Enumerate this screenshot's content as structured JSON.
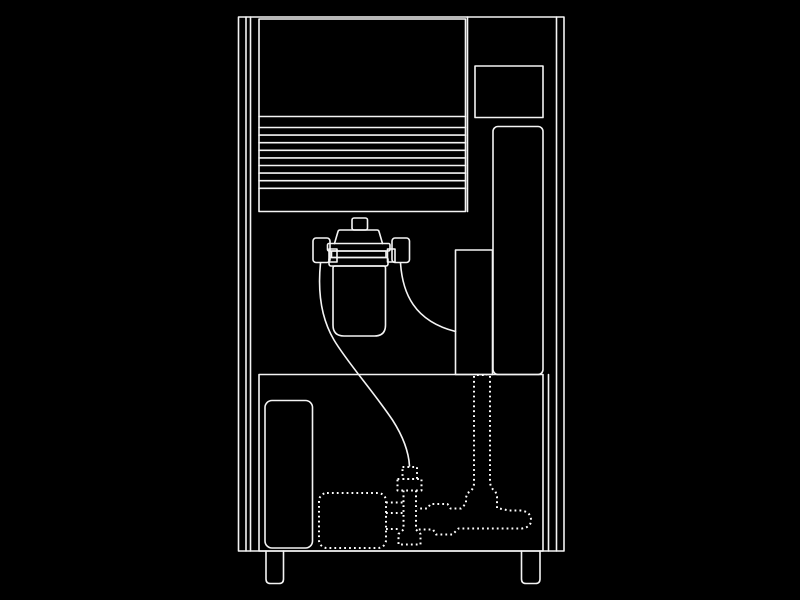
{
  "diagram": {
    "title": "machine-internal-schematic",
    "style": "white line drawing on black background, lower plumbing drawn dotted",
    "components": {
      "cabinet": "machine cabinet outline with double-line side edges",
      "louver_panel": "front door panel with horizontal louver vents",
      "top_right_panel": "small rectangular panel, upper right",
      "right_column": "tall rounded rectangular column, right side",
      "mid_right_box": "rectangular box beside filter outlet",
      "bottom_compartment": "lower machinery compartment",
      "left_reservoir": "rounded rectangle inside lower compartment",
      "water_filter": "filter canister with cap knob, collar rings and two side fittings",
      "left_tube": "curved tube from left fitting down to inlet fitting",
      "right_tube": "curved tube from right fitting to mid right box",
      "pump": "dotted pump body",
      "inlet_fitting": "dotted stacked fitting below tube end",
      "valve": "dotted valve body with flared foot",
      "manifold": "dotted horizontal manifold with rounded end cap",
      "standpipe": "dotted vertical pipe pair rising to mid right box",
      "feet": "two support feet under cabinet"
    }
  },
  "colors": {
    "background": "#000000",
    "line": "#f4f4f4",
    "dotted_line": "#ffffff"
  }
}
